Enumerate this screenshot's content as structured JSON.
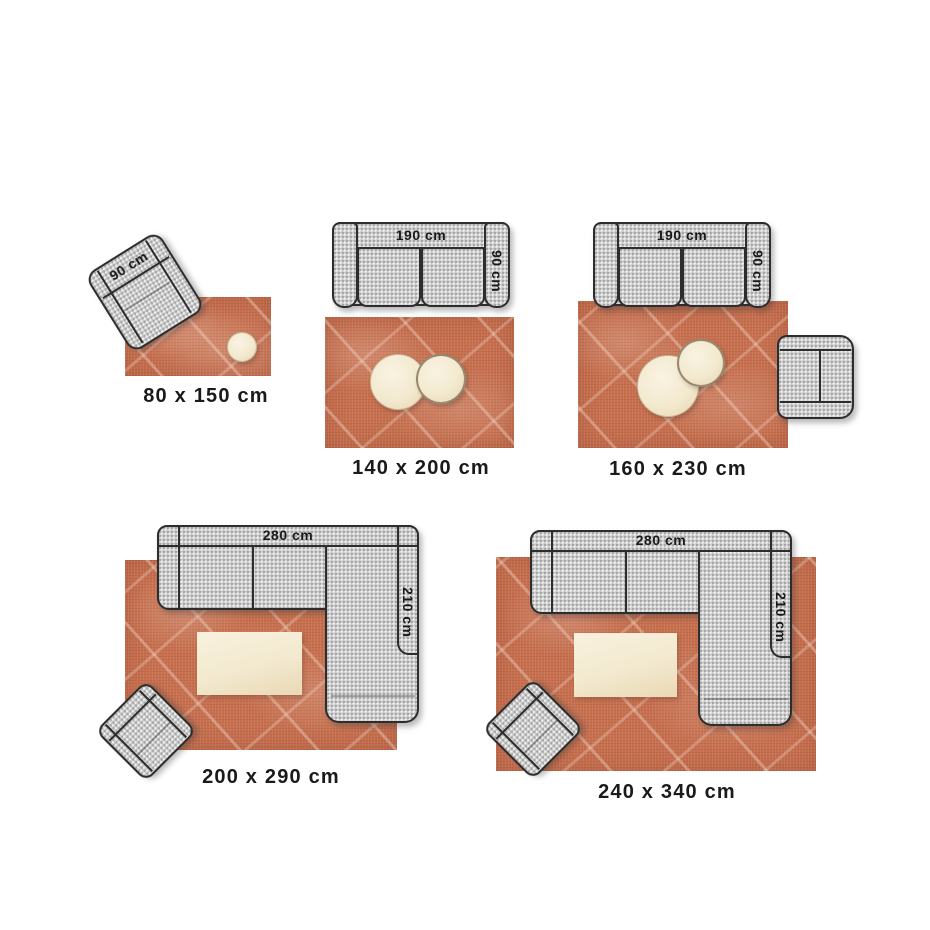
{
  "colors": {
    "page_bg": "#ffffff",
    "rug": "#c7704f",
    "rug_pattern": "#f4dbcc",
    "fabric": "#c9c9c9",
    "outline": "#2d2d2d",
    "table": "#f3e9cf",
    "label_text": "#1a1a1a"
  },
  "scenes": [
    {
      "name": "80x150",
      "caption": "80 x 150 cm",
      "armchair_label": "90 cm"
    },
    {
      "name": "140x200",
      "caption": "140 x 200 cm",
      "sofa_width_label": "190 cm",
      "sofa_depth_label": "90 cm"
    },
    {
      "name": "160x230",
      "caption": "160 x 230 cm",
      "sofa_width_label": "190 cm",
      "sofa_depth_label": "90 cm"
    },
    {
      "name": "200x290",
      "caption": "200 x 290 cm",
      "sofa_width_label": "280 cm",
      "sofa_depth_label": "210 cm"
    },
    {
      "name": "240x340",
      "caption": "240 x 340 cm",
      "sofa_width_label": "280 cm",
      "sofa_depth_label": "210 cm"
    }
  ]
}
